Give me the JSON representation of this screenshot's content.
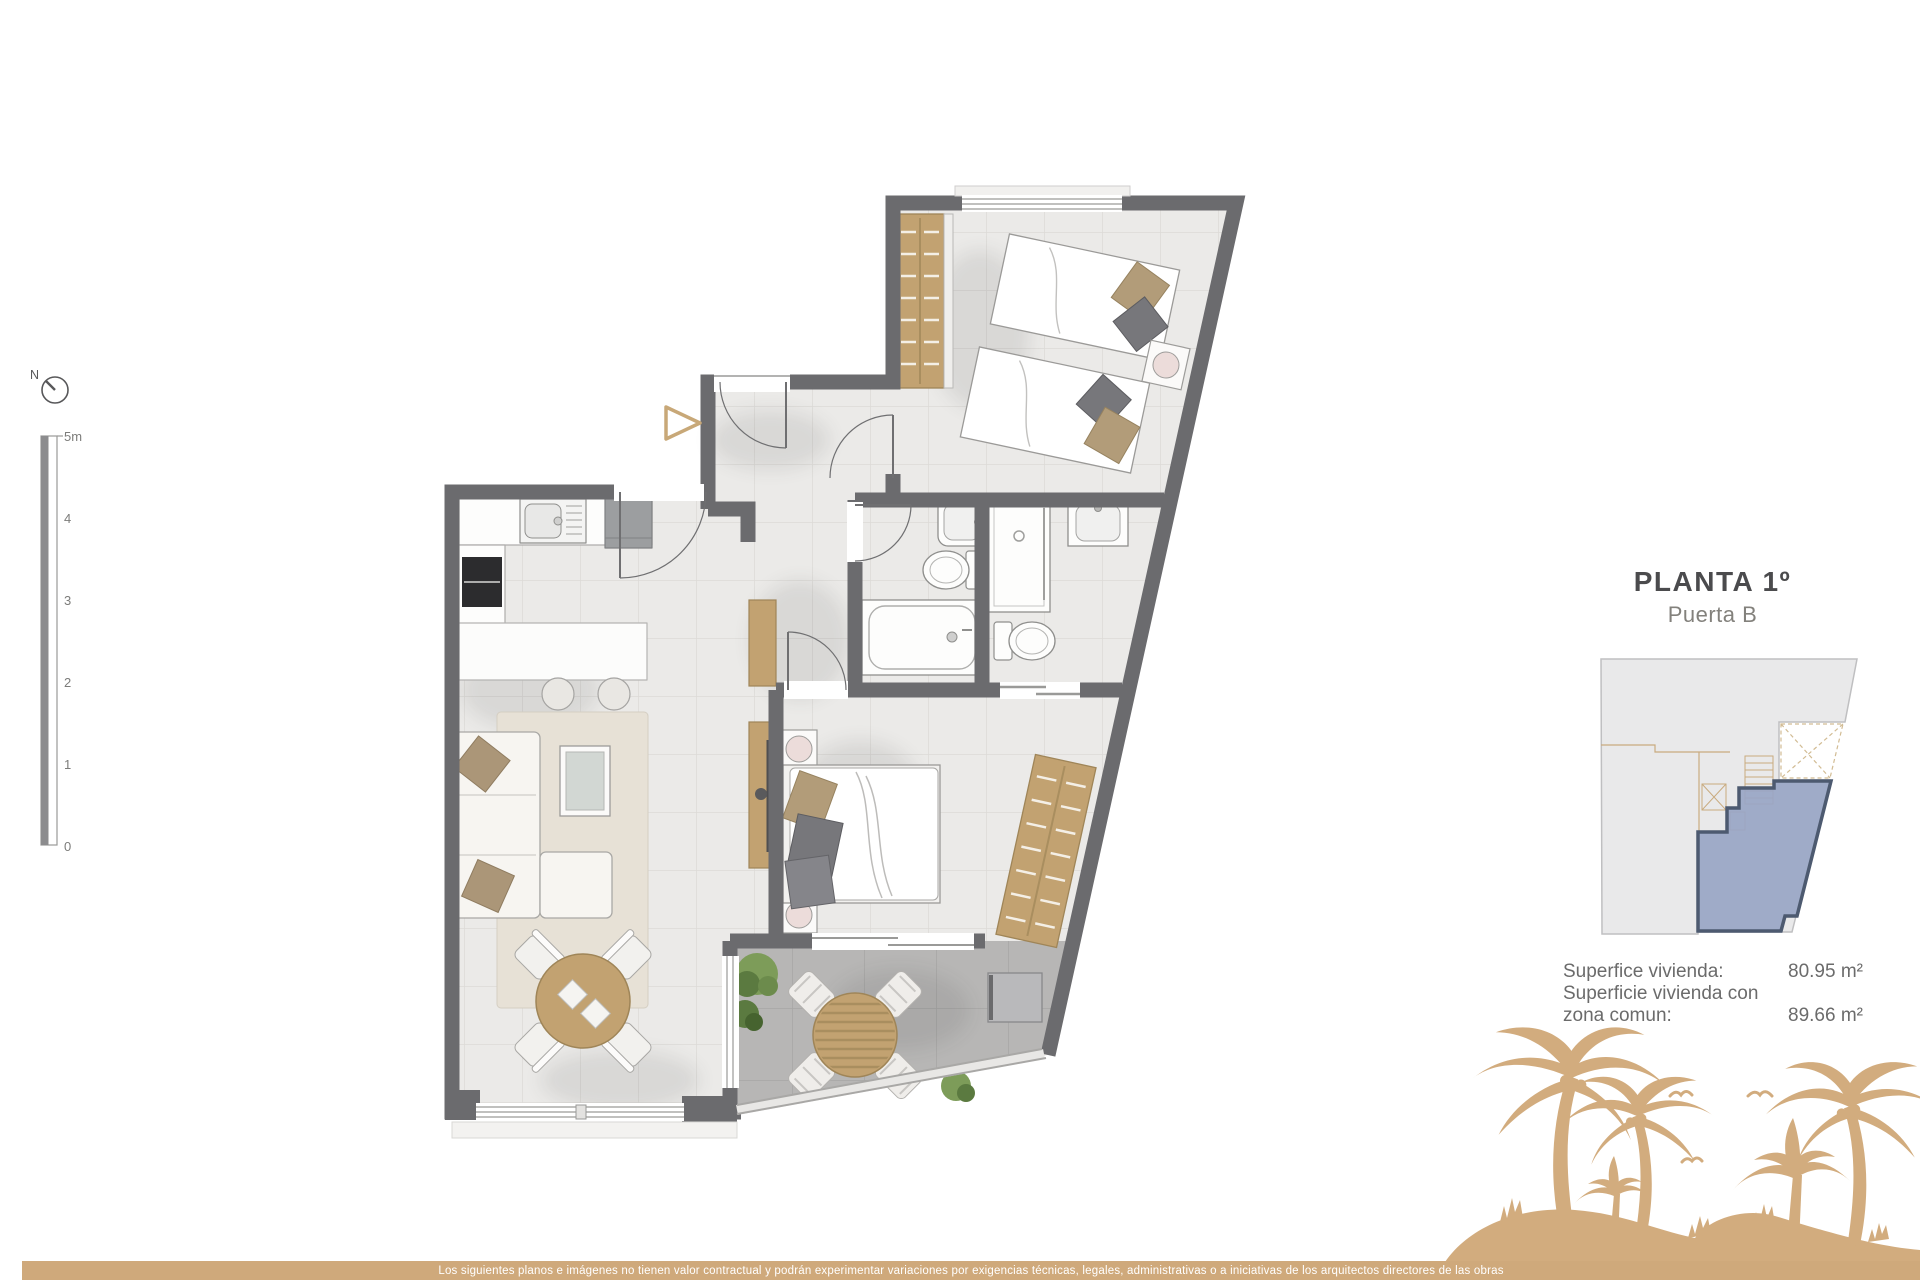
{
  "title": {
    "floor": "PLANTA 1º",
    "door": "Puerta B"
  },
  "areas": {
    "rows": [
      {
        "label": "Superfice vivienda:",
        "value": "80.95 m²"
      },
      {
        "label": "Superficie vivienda con",
        "value": ""
      },
      {
        "label": "zona comun:",
        "value": "89.66 m²"
      }
    ]
  },
  "compass": {
    "label": "N"
  },
  "scalebar": {
    "labels": [
      "5m",
      "4",
      "3",
      "2",
      "1",
      "0"
    ]
  },
  "footer": {
    "disclaimer": "Los siguientes planos e imágenes no tienen valor contractual y podrán experimentar variaciones por exigencias técnicas, legales, administrativas o a iniciativas de los arquitectos directores de las obras"
  },
  "colors": {
    "wall_gray": "#6b6b6e",
    "floor_light": "#ebeae8",
    "terrace_gray": "#b7b6b5",
    "wood_tan": "#c2a271",
    "accent_tan": "#cfa97b",
    "palm_tan": "#d2ac7e",
    "unit_highlight_blue": "#98a5c4",
    "title_dark": "#4b4b4d"
  }
}
